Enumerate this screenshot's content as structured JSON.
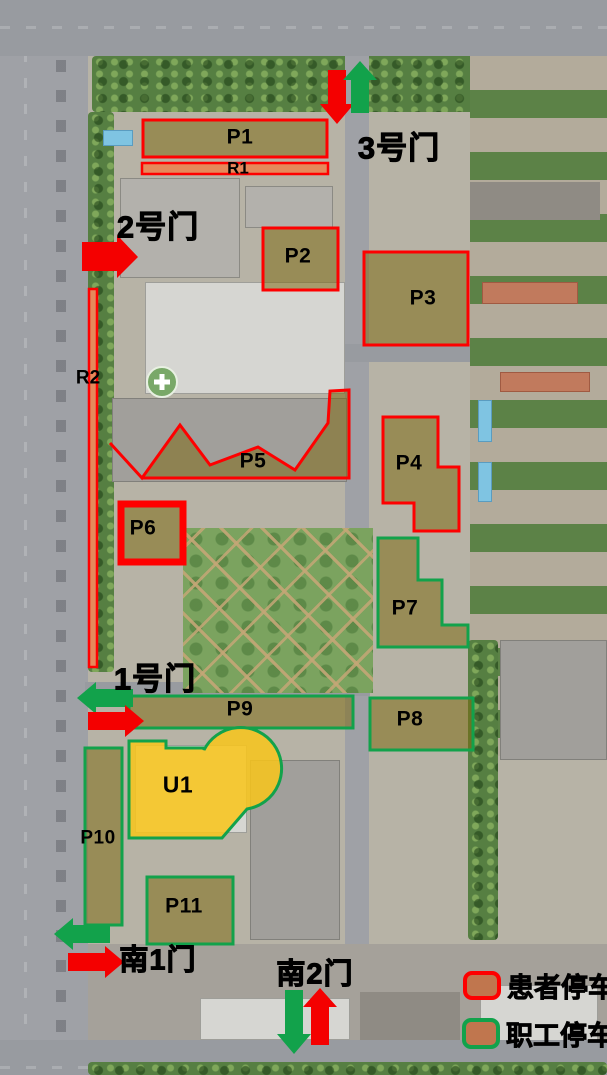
{
  "map": {
    "zones": [
      {
        "id": "P1",
        "label": "P1",
        "type": "patient"
      },
      {
        "id": "R1",
        "label": "R1",
        "type": "patient-reserved-road"
      },
      {
        "id": "P2",
        "label": "P2",
        "type": "patient"
      },
      {
        "id": "P3",
        "label": "P3",
        "type": "patient"
      },
      {
        "id": "R2",
        "label": "R2",
        "type": "patient-reserved-road"
      },
      {
        "id": "P5",
        "label": "P5",
        "type": "patient"
      },
      {
        "id": "P6",
        "label": "P6",
        "type": "patient"
      },
      {
        "id": "P4",
        "label": "P4",
        "type": "patient"
      },
      {
        "id": "P7",
        "label": "P7",
        "type": "staff"
      },
      {
        "id": "P8",
        "label": "P8",
        "type": "staff"
      },
      {
        "id": "P9",
        "label": "P9",
        "type": "staff"
      },
      {
        "id": "P10",
        "label": "P10",
        "type": "staff"
      },
      {
        "id": "P11",
        "label": "P11",
        "type": "staff"
      },
      {
        "id": "U1",
        "label": "U1",
        "type": "staff"
      }
    ],
    "gates": [
      {
        "id": "gate-3",
        "label": "3号门",
        "arrows": [
          "red-down",
          "green-up"
        ]
      },
      {
        "id": "gate-2",
        "label": "2号门",
        "arrows": [
          "red-right"
        ]
      },
      {
        "id": "gate-1",
        "label": "1号门",
        "arrows": [
          "green-left",
          "red-right"
        ]
      },
      {
        "id": "gate-south-1",
        "label": "南1门",
        "arrows": [
          "green-left",
          "red-right"
        ]
      },
      {
        "id": "gate-south-2",
        "label": "南2门",
        "arrows": [
          "green-down",
          "red-up"
        ]
      }
    ],
    "legend": [
      {
        "label": "患者停车",
        "type": "patient"
      },
      {
        "label": "职工停车",
        "type": "staff"
      }
    ],
    "colors": {
      "patient_outline": "#fe0000",
      "staff_outline": "#12a24b",
      "reserved_road_fill": "#e5895b",
      "zone_fill_olive": "#7c6810",
      "u1_fill": "#f9c61a",
      "entry_arrow": "#f40000",
      "exit_arrow": "#12a24b",
      "legend_swatch_fill": "#c0764e"
    }
  }
}
